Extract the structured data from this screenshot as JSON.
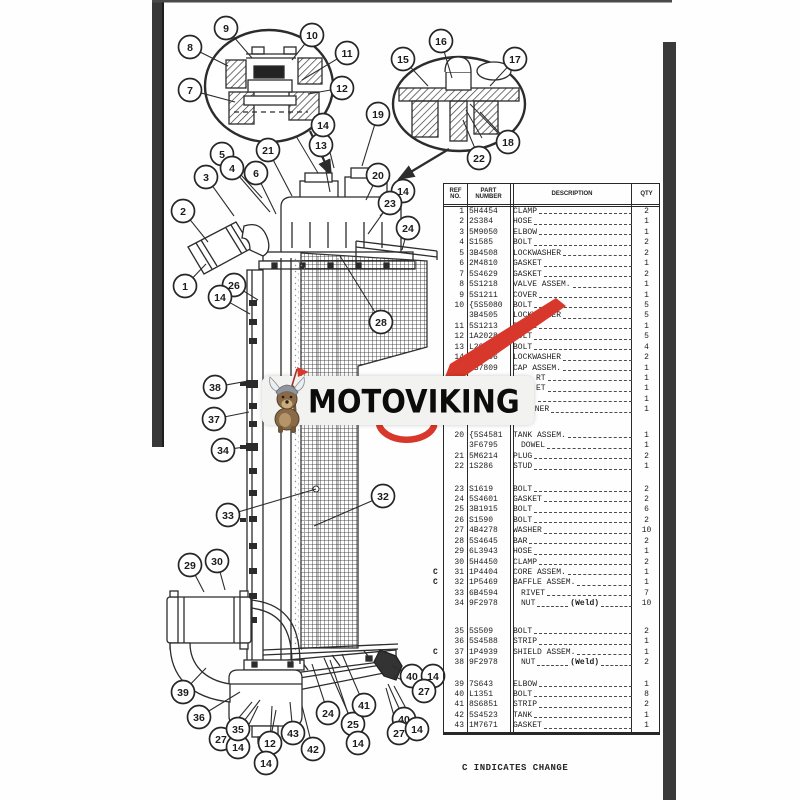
{
  "page": {
    "footnote": "C INDICATES CHANGE",
    "watermark": {
      "text": "MOTOVIKING",
      "mascot": "viking-dog-mascot"
    }
  },
  "colors": {
    "red": "#d8382b",
    "ink": "#2c2c2c",
    "scan_bar": "#3a3a3a",
    "banner_bg": "#f2f2f0",
    "logo_text": "#0c0c0c"
  },
  "table": {
    "headers": {
      "ref": "REF\nNO.",
      "part": "PART\nNUMBER",
      "desc": "DESCRIPTION",
      "qty": "QTY"
    },
    "rows": [
      {
        "ref": "1",
        "part": "5H4454",
        "desc": "CLAMP",
        "qty": "2"
      },
      {
        "ref": "2",
        "part": "2S384",
        "desc": "HOSE",
        "qty": "1"
      },
      {
        "ref": "3",
        "part": "5M9050",
        "desc": "ELBOW",
        "qty": "1"
      },
      {
        "ref": "4",
        "part": "S1585",
        "desc": "BOLT",
        "qty": "2"
      },
      {
        "ref": "5",
        "part": "3B4508",
        "desc": "LOCKWASHER",
        "qty": "2"
      },
      {
        "ref": "6",
        "part": "2M4810",
        "desc": "GASKET",
        "qty": "1"
      },
      {
        "ref": "7",
        "part": "5S4629",
        "desc": "GASKET",
        "qty": "2"
      },
      {
        "ref": "8",
        "part": "5S1218",
        "desc": "VALVE ASSEM.",
        "qty": "1"
      },
      {
        "ref": "9",
        "part": "5S1211",
        "desc": "COVER",
        "qty": "1"
      },
      {
        "ref": "10",
        "part": "5S5080",
        "desc": "BOLT",
        "qty": "5",
        "brace": true
      },
      {
        "ref": "",
        "part": "3B4505",
        "desc": "LOCKWASHER",
        "qty": "5"
      },
      {
        "ref": "11",
        "part": "5S1213",
        "desc": "PLATE",
        "qty": "1"
      },
      {
        "ref": "12",
        "part": "1A2028",
        "desc": "BOLT",
        "qty": "5"
      },
      {
        "ref": "13",
        "part": "L204",
        "desc": "BOLT",
        "qty": "4"
      },
      {
        "ref": "14",
        "part": "3B4506",
        "desc": "LOCKWASHER",
        "qty": "2"
      },
      {
        "ref": "",
        "part": "2S7809",
        "desc": "CAP ASSEM.",
        "qty": "1"
      },
      {
        "ref": "",
        "part": "",
        "desc": "RT",
        "qty": "1",
        "ind": 3
      },
      {
        "ref": "",
        "part": "",
        "desc": "ET",
        "qty": "1",
        "ind": 3
      },
      {
        "ref": "",
        "part": "",
        "desc": "",
        "qty": "1",
        "ind": 3
      },
      {
        "ref": "",
        "part": "",
        "desc": "INER",
        "qty": "1",
        "ind": 2
      },
      {
        "ref": "20",
        "part": "5S4581",
        "desc": "TANK ASSEM.",
        "qty": "1",
        "gap": 15,
        "brace": true
      },
      {
        "ref": "",
        "part": "3F6795",
        "desc": "DOWEL",
        "qty": "1",
        "ind": 1
      },
      {
        "ref": "21",
        "part": "5M6214",
        "desc": "PLUG",
        "qty": "2"
      },
      {
        "ref": "22",
        "part": "1S286",
        "desc": "STUD",
        "qty": "1"
      },
      {
        "ref": "23",
        "part": "S1619",
        "desc": "BOLT",
        "qty": "2",
        "gap": 12
      },
      {
        "ref": "24",
        "part": "5S4601",
        "desc": "GASKET",
        "qty": "2"
      },
      {
        "ref": "25",
        "part": "3B1915",
        "desc": "BOLT",
        "qty": "6"
      },
      {
        "ref": "26",
        "part": "S1590",
        "desc": "BOLT",
        "qty": "2"
      },
      {
        "ref": "27",
        "part": "4B4278",
        "desc": "WASHER",
        "qty": "10"
      },
      {
        "ref": "28",
        "part": "5S4645",
        "desc": "BAR",
        "qty": "2"
      },
      {
        "ref": "29",
        "part": "6L3943",
        "desc": "HOSE",
        "qty": "1"
      },
      {
        "ref": "30",
        "part": "5H4450",
        "desc": "CLAMP",
        "qty": "2"
      },
      {
        "ref": "31",
        "part": "1P4404",
        "desc": "CORE ASSEM.",
        "qty": "1",
        "c": true
      },
      {
        "ref": "32",
        "part": "1P5469",
        "desc": "BAFFLE ASSEM.",
        "qty": "1",
        "c": true
      },
      {
        "ref": "33",
        "part": "6B4594",
        "desc": "RIVET",
        "qty": "7",
        "ind": 1
      },
      {
        "ref": "34",
        "part": "9F2978",
        "desc": "NUT",
        "qty": "10",
        "ind": 1,
        "mid": "(Weld)"
      },
      {
        "ref": "35",
        "part": "5S509",
        "desc": "BOLT",
        "qty": "2",
        "gap": 17
      },
      {
        "ref": "36",
        "part": "5S4588",
        "desc": "STRIP",
        "qty": "1"
      },
      {
        "ref": "37",
        "part": "1P4939",
        "desc": "SHIELD ASSEM.",
        "qty": "1",
        "c": true
      },
      {
        "ref": "38",
        "part": "9F2978",
        "desc": "NUT",
        "qty": "2",
        "ind": 1,
        "mid": "(Weld)"
      },
      {
        "ref": "39",
        "part": "7S643",
        "desc": "ELBOW",
        "qty": "1",
        "gap": 11
      },
      {
        "ref": "40",
        "part": "L1351",
        "desc": "BOLT",
        "qty": "8"
      },
      {
        "ref": "41",
        "part": "8S6851",
        "desc": "STRIP",
        "qty": "2"
      },
      {
        "ref": "42",
        "part": "5S4523",
        "desc": "TANK",
        "qty": "1"
      },
      {
        "ref": "43",
        "part": "1M7671",
        "desc": "GASKET",
        "qty": "1"
      }
    ]
  },
  "callouts": [
    {
      "n": "7",
      "x": 190,
      "y": 90,
      "tx": 235,
      "ty": 102
    },
    {
      "n": "8",
      "x": 190,
      "y": 47,
      "tx": 228,
      "ty": 66
    },
    {
      "n": "9",
      "x": 226,
      "y": 28,
      "tx": 252,
      "ty": 58
    },
    {
      "n": "10",
      "x": 312,
      "y": 35,
      "tx": 292,
      "ty": 60
    },
    {
      "n": "11",
      "x": 347,
      "y": 53,
      "tx": 302,
      "ty": 80
    },
    {
      "n": "12",
      "x": 342,
      "y": 88,
      "tx": 308,
      "ty": 94
    },
    {
      "n": "15",
      "x": 403,
      "y": 59,
      "tx": 428,
      "ty": 86
    },
    {
      "n": "16",
      "x": 441,
      "y": 41,
      "tx": 452,
      "ty": 78
    },
    {
      "n": "17",
      "x": 515,
      "y": 59,
      "tx": 490,
      "ty": 86
    },
    {
      "n": "18",
      "x": 508,
      "y": 142,
      "tx": 480,
      "ty": 112
    },
    {
      "n": "22",
      "x": 479,
      "y": 158,
      "tx": 463,
      "ty": 120
    },
    {
      "n": "19",
      "x": 378,
      "y": 114,
      "tx": 362,
      "ty": 166
    },
    {
      "n": "5",
      "x": 222,
      "y": 154,
      "tx": 262,
      "ty": 198
    },
    {
      "n": "4",
      "x": 232,
      "y": 168,
      "tx": 270,
      "ty": 212
    },
    {
      "n": "3",
      "x": 206,
      "y": 177,
      "tx": 234,
      "ty": 216
    },
    {
      "n": "6",
      "x": 256,
      "y": 173,
      "tx": 276,
      "ty": 214
    },
    {
      "n": "21",
      "x": 268,
      "y": 150,
      "tx": 292,
      "ty": 196
    },
    {
      "n": "13",
      "x": 321,
      "y": 145,
      "tx": 330,
      "ty": 192
    },
    {
      "n": "14",
      "x": 323,
      "y": 125,
      "tx": 334,
      "ty": 168
    },
    {
      "n": "2",
      "x": 183,
      "y": 211,
      "tx": 208,
      "ty": 242
    },
    {
      "n": "1",
      "x": 185,
      "y": 286,
      "tx": 206,
      "ty": 264
    },
    {
      "n": "20",
      "x": 378,
      "y": 175,
      "tx": 366,
      "ty": 200
    },
    {
      "n": "14",
      "x": 403,
      "y": 191,
      "tx": 380,
      "ty": 216
    },
    {
      "n": "23",
      "x": 390,
      "y": 203,
      "tx": 368,
      "ty": 234
    },
    {
      "n": "24",
      "x": 408,
      "y": 228,
      "tx": 402,
      "ty": 250
    },
    {
      "n": "26",
      "x": 234,
      "y": 285,
      "tx": 258,
      "ty": 300
    },
    {
      "n": "14",
      "x": 220,
      "y": 297,
      "tx": 250,
      "ty": 314
    },
    {
      "n": "28",
      "x": 381,
      "y": 322,
      "tx": 340,
      "ty": 256
    },
    {
      "n": "38",
      "x": 215,
      "y": 387,
      "tx": 248,
      "ty": 381
    },
    {
      "n": "37",
      "x": 214,
      "y": 419,
      "tx": 249,
      "ty": 412
    },
    {
      "n": "34",
      "x": 223,
      "y": 450,
      "tx": 252,
      "ty": 446
    },
    {
      "n": "33",
      "x": 228,
      "y": 515,
      "tx": 316,
      "ty": 489
    },
    {
      "n": "32",
      "x": 383,
      "y": 496,
      "tx": 314,
      "ty": 526
    },
    {
      "n": "29",
      "x": 190,
      "y": 565,
      "tx": 204,
      "ty": 592
    },
    {
      "n": "30",
      "x": 217,
      "y": 561,
      "tx": 225,
      "ty": 590
    },
    {
      "n": "39",
      "x": 183,
      "y": 692,
      "tx": 206,
      "ty": 668
    },
    {
      "n": "36",
      "x": 199,
      "y": 717,
      "tx": 240,
      "ty": 692
    },
    {
      "n": "27",
      "x": 221,
      "y": 739,
      "tx": 252,
      "ty": 702
    },
    {
      "n": "14",
      "x": 238,
      "y": 747,
      "tx": 258,
      "ty": 706
    },
    {
      "n": "35",
      "x": 238,
      "y": 729,
      "tx": 260,
      "ty": 700
    },
    {
      "n": "12",
      "x": 270,
      "y": 743,
      "tx": 272,
      "ty": 706
    },
    {
      "n": "14",
      "x": 266,
      "y": 763,
      "tx": 276,
      "ty": 710
    },
    {
      "n": "43",
      "x": 293,
      "y": 733,
      "tx": 290,
      "ty": 702
    },
    {
      "n": "42",
      "x": 313,
      "y": 749,
      "tx": 302,
      "ty": 706
    },
    {
      "n": "24",
      "x": 328,
      "y": 713,
      "tx": 312,
      "ty": 664
    },
    {
      "n": "25",
      "x": 353,
      "y": 724,
      "tx": 324,
      "ty": 658
    },
    {
      "n": "14",
      "x": 358,
      "y": 743,
      "tx": 330,
      "ty": 660
    },
    {
      "n": "41",
      "x": 364,
      "y": 705,
      "tx": 342,
      "ty": 654
    },
    {
      "n": "40",
      "x": 412,
      "y": 676,
      "tx": 392,
      "ty": 666
    },
    {
      "n": "14",
      "x": 433,
      "y": 676,
      "tx": 400,
      "ty": 670
    },
    {
      "n": "27",
      "x": 424,
      "y": 691,
      "tx": 394,
      "ty": 676
    },
    {
      "n": "40",
      "x": 404,
      "y": 719,
      "tx": 388,
      "ty": 684
    },
    {
      "n": "27",
      "x": 399,
      "y": 733,
      "tx": 386,
      "ty": 688
    },
    {
      "n": "14",
      "x": 417,
      "y": 729,
      "tx": 394,
      "ty": 686
    }
  ]
}
